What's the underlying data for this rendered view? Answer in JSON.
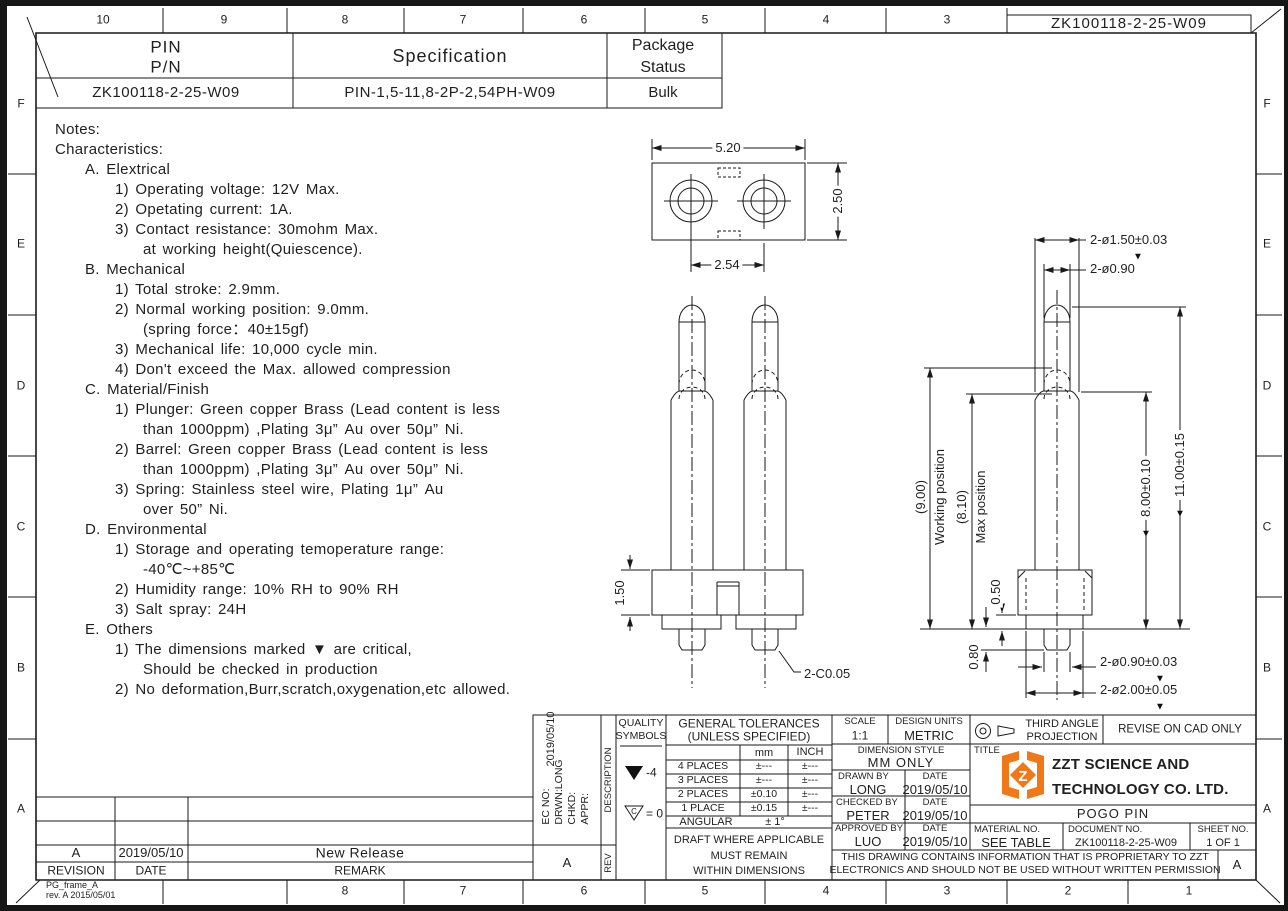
{
  "colors": {
    "line": "#1a1a1a",
    "logo_orange": "#F07818"
  },
  "icons": {
    "critical": "▼"
  },
  "frame": {
    "doc_box": "ZK100118-2-25-W09",
    "cols_top": [
      "10",
      "9",
      "8",
      "7",
      "6",
      "5",
      "4",
      "3"
    ],
    "cols_bottom": [
      "8",
      "7",
      "6",
      "5",
      "4",
      "3",
      "2",
      "1"
    ],
    "rows_left": [
      "F",
      "E",
      "D",
      "C",
      "B",
      "A"
    ],
    "rows_right": [
      "F",
      "E",
      "D",
      "C",
      "B",
      "A"
    ],
    "frame_name": "PG_frame_A",
    "frame_rev": "rev. A  2015/05/01"
  },
  "header_table": {
    "col1_line1": "PIN",
    "col1_line2": "P/N",
    "col2": "Specification",
    "col3_line1": "Package",
    "col3_line2": "Status",
    "pin_pn": "ZK100118-2-25-W09",
    "specification": "PIN-1,5-11,8-2P-2,54PH-W09",
    "package_status": "Bulk"
  },
  "notes": {
    "lines": [
      {
        "t": "Notes:",
        "i": 0
      },
      {
        "t": "Characteristics:",
        "i": 0
      },
      {
        "t": "A. Elextrical",
        "i": 1
      },
      {
        "t": "1) Operating voltage: 12V Max.",
        "i": 2
      },
      {
        "t": "2) Opetating current: 1A.",
        "i": 2
      },
      {
        "t": "3) Contact resistance: 30mohm Max.",
        "i": 2
      },
      {
        "t": "at working height(Quiescence).",
        "i": 3
      },
      {
        "t": "B. Mechanical",
        "i": 1
      },
      {
        "t": "1) Total stroke: 2.9mm.",
        "i": 2
      },
      {
        "t": "2) Normal working position: 9.0mm.",
        "i": 2
      },
      {
        "t": "(spring force：40±15gf)",
        "i": 3
      },
      {
        "t": "3) Mechanical life: 10,000 cycle min.",
        "i": 2
      },
      {
        "t": "4) Don't exceed the Max. allowed compression",
        "i": 2
      },
      {
        "t": "C. Material/Finish",
        "i": 1
      },
      {
        "t": "1) Plunger: Green copper Brass (Lead content is less",
        "i": 2
      },
      {
        "t": "than 1000ppm) ,Plating 3μ” Au over 50μ” Ni.",
        "i": 3
      },
      {
        "t": "2) Barrel: Green copper Brass (Lead content is less",
        "i": 2
      },
      {
        "t": "than 1000ppm) ,Plating 3μ” Au over 50μ” Ni.",
        "i": 3
      },
      {
        "t": "3) Spring: Stainless steel wire, Plating 1μ” Au",
        "i": 2
      },
      {
        "t": "over 50” Ni.",
        "i": 3
      },
      {
        "t": "D. Environmental",
        "i": 1
      },
      {
        "t": "1) Storage and operating temoperature range:",
        "i": 2
      },
      {
        "t": "-40℃~+85℃",
        "i": 3
      },
      {
        "t": "2) Humidity range: 10% RH to 90% RH",
        "i": 2
      },
      {
        "t": "3) Salt spray: 24H",
        "i": 2
      },
      {
        "t": "E. Others",
        "i": 1
      },
      {
        "t": "1) The dimensions marked ▼ are critical,",
        "i": 2
      },
      {
        "t": "Should be checked in production",
        "i": 3
      },
      {
        "t": "2) No deformation,Burr,scratch,oxygenation,etc allowed.",
        "i": 2
      }
    ]
  },
  "dims": {
    "top_width": "5.20",
    "top_height": "2.50",
    "top_pitch": "2.54",
    "front_base": "1.50",
    "front_chamfer": "2-C0.05",
    "side_d150": "2-ø1.50±0.03",
    "side_d090": "2-ø0.90",
    "side_working_val": "(9.00)",
    "side_working_lbl": "Working position",
    "side_max_val": "(8.10)",
    "side_max_lbl": "Max position",
    "side_050": "0.50",
    "side_080": "0.80",
    "side_800": "8.00±0.10",
    "side_1100": "11.00±0.15",
    "side_pin_d": "2-ø0.90±0.03",
    "side_base_d": "2-ø2.00±0.05"
  },
  "revisions": {
    "rev": "A",
    "date": "2019/05/10",
    "remark": "New Release",
    "h_rev": "REVISION",
    "h_date": "DATE",
    "h_remark": "REMARK"
  },
  "tb": {
    "ec_line1": "EC NO:",
    "ec_line2": "DRWN:LONG",
    "ec_line3": "CHKD:",
    "ec_line4": "APPR:",
    "ec_date": "2019/05/10",
    "ec_rev": "A",
    "description": "DESCRIPTION",
    "rev": "REV",
    "quality1": "QUALITY",
    "quality2": "SYMBOLS",
    "q_filled": "-4",
    "q_open_letter": "C",
    "q_open": "= 0",
    "tol_title1": "GENERAL TOLERANCES",
    "tol_title2": "(UNLESS SPECIFIED)",
    "tol_mm": "mm",
    "tol_inch": "INCH",
    "tol_rows": [
      {
        "l": "4 PLACES",
        "mm": "±---",
        "in": "±---"
      },
      {
        "l": "3 PLACES",
        "mm": "±---",
        "in": "±---"
      },
      {
        "l": "2 PLACES",
        "mm": "±0.10",
        "in": "±---"
      },
      {
        "l": "1 PLACE",
        "mm": "±0.15",
        "in": "±---"
      }
    ],
    "angular": "ANGULAR",
    "angular_val": "± 1°",
    "draft1": "DRAFT WHERE APPLICABLE",
    "draft2": "MUST REMAIN",
    "draft3": "WITHIN DIMENSIONS",
    "scale_l": "SCALE",
    "scale_v": "1:1",
    "units_l": "DESIGN UNITS",
    "units_v": "METRIC",
    "dimstyle_l": "DIMENSION STYLE",
    "dimstyle_v": "MM ONLY",
    "drawn_l": "DRAWN BY",
    "date_l": "DATE",
    "drawn_v": "LONG",
    "drawn_d": "2019/05/10",
    "checked_l": "CHECKED BY",
    "checked_v": "PETER",
    "checked_d": "2019/05/10",
    "approved_l": "APPROVED BY",
    "approved_v": "LUO",
    "approved_d": "2019/05/10",
    "proj1": "THIRD ANGLE",
    "proj2": "PROJECTION",
    "revise": "REVISE ON CAD ONLY",
    "title_l": "TITLE",
    "company1": "ZZT SCIENCE AND",
    "company2": "TECHNOLOGY CO. LTD.",
    "product": "POGO PIN",
    "material_l": "MATERIAL NO.",
    "material_v": "SEE TABLE",
    "doc_l": "DOCUMENT NO.",
    "doc_v": "ZK100118-2-25-W09",
    "sheet_l": "SHEET NO.",
    "sheet_v": "1 OF 1",
    "prop1": "THIS DRAWING CONTAINS INFORMATION THAT IS PROPRIETARY TO ZZT",
    "prop2": "ELECTRONICS AND SHOULD NOT BE USED WITHOUT WRITTEN PERMISSION",
    "rev_letter": "A"
  }
}
